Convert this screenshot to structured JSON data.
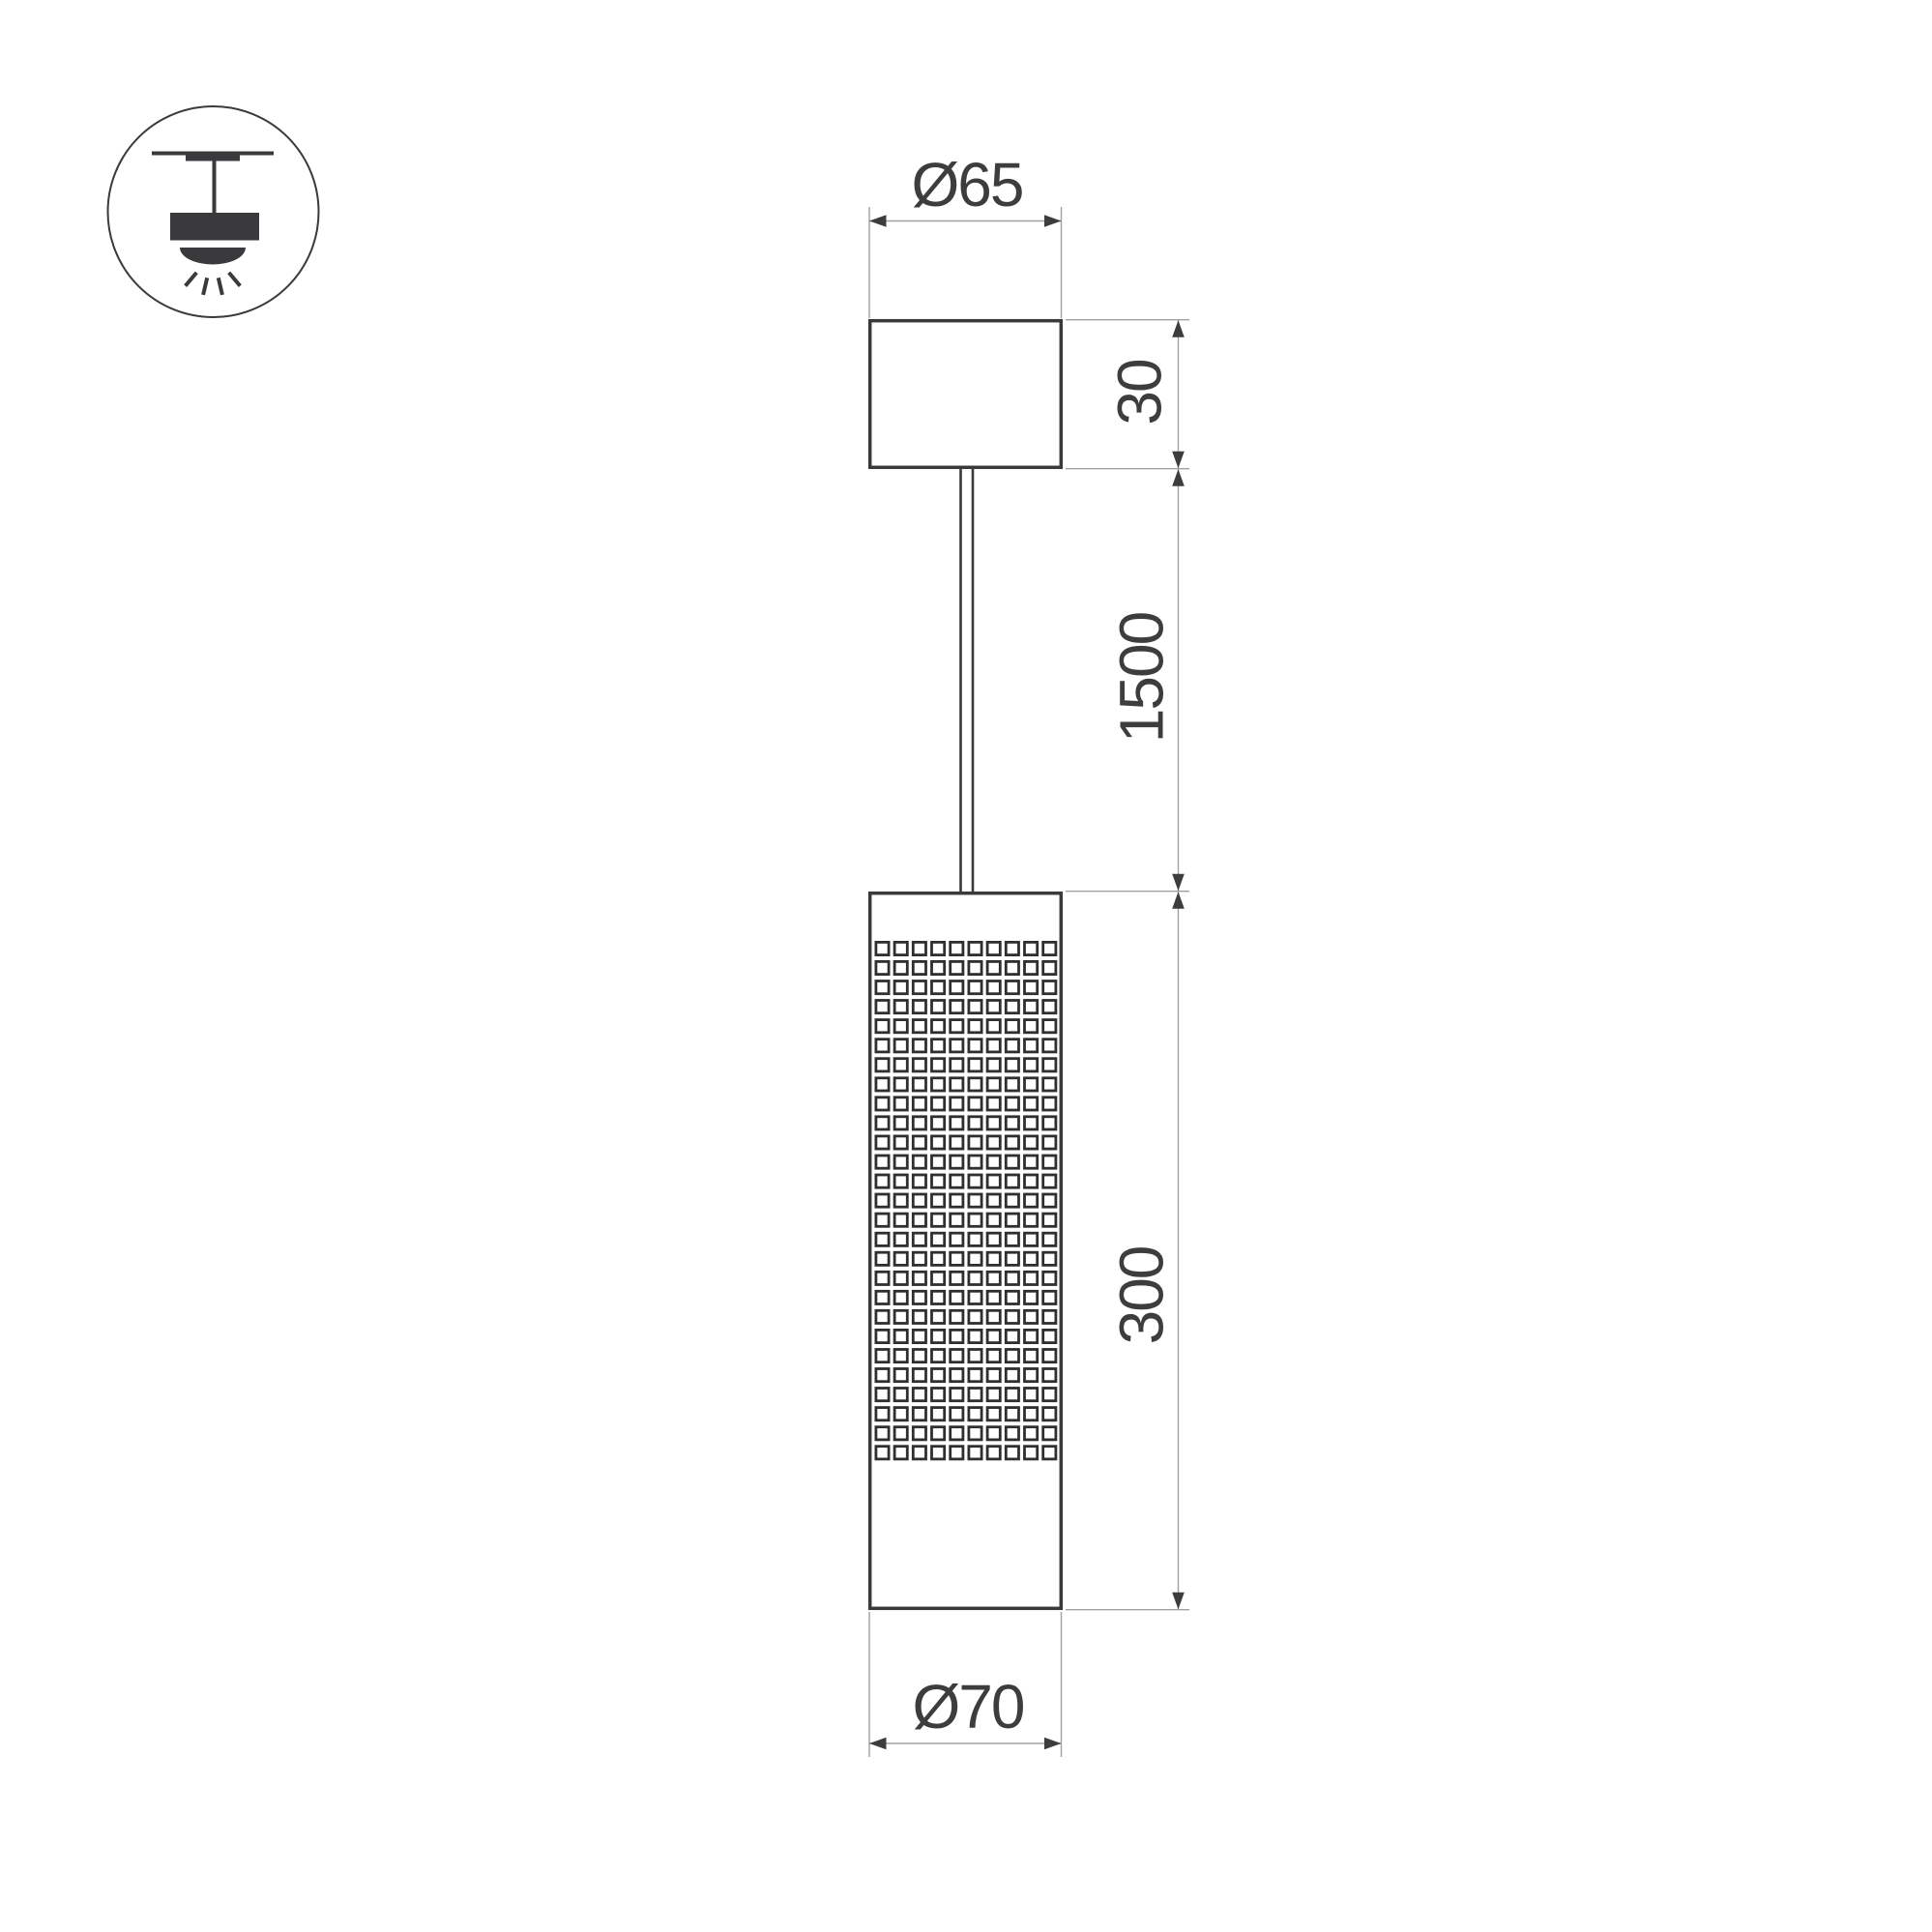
{
  "page": {
    "background": "#ffffff",
    "type": "technical-dimension-drawing"
  },
  "icon": {
    "name": "pendant-ceiling-light-symbol"
  },
  "dimensions": {
    "top_diameter": "Ø65",
    "canopy_height": "30",
    "suspension_length": "1500",
    "body_height": "300",
    "bottom_diameter": "Ø70"
  },
  "colors": {
    "object_outline": "#3a3a3c",
    "mesh_stroke": "#2f2f31",
    "dimension_lines": "#a0a0a0",
    "dimension_text": "#3d3d3f",
    "background": "#ffffff"
  },
  "mesh": {
    "columns": 10,
    "rows": 27,
    "cell_outer": 16,
    "pitch_x": 19.2,
    "pitch_y": 20.05,
    "origin_x": 905.9,
    "origin_y": 974.4,
    "stroke": "#2f2f31",
    "stroke_width": 2.8
  }
}
